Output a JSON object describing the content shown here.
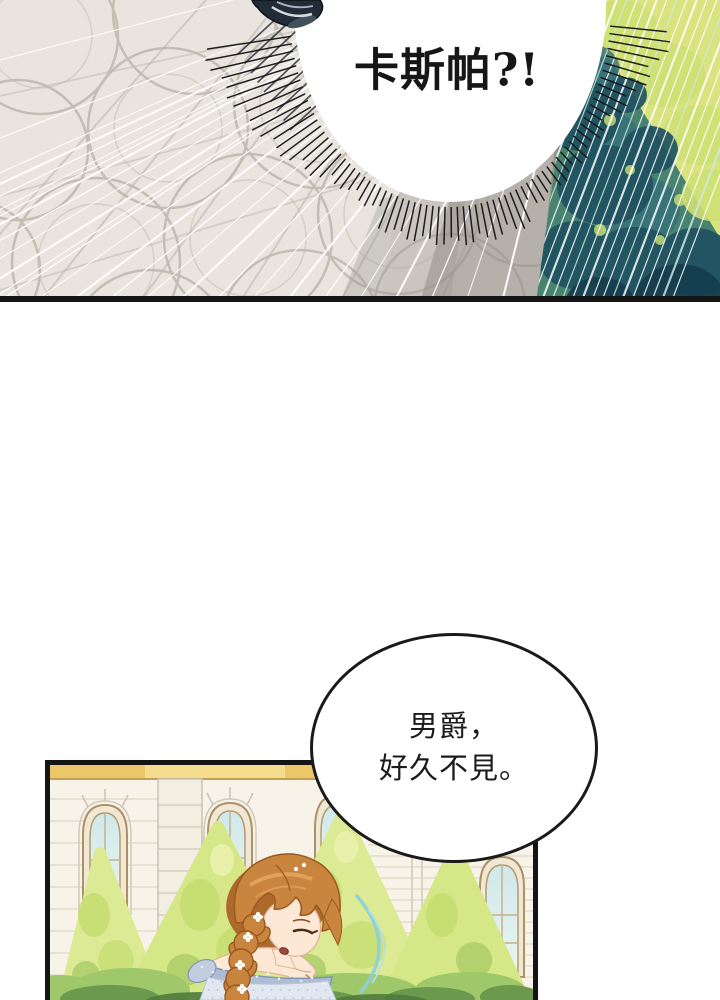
{
  "page": {
    "type": "comic-page",
    "background": "#ffffff"
  },
  "panel1": {
    "label": "courtyard-shout-panel",
    "bubble_text": "卡斯帕?!",
    "colors": {
      "floor": "#e9e5de",
      "floor_pattern": "#b6b1a5",
      "floor_shadow": "#8f8b85",
      "foliage_dark": "#1f5260",
      "foliage_mid": "#47836e",
      "foliage_light": "#d9e37f",
      "ink": "#151515",
      "speedline": "#ffffff"
    }
  },
  "panel2": {
    "label": "garden-greeting-panel",
    "bubble_line1": "男爵，",
    "bubble_line2": "好久不見。",
    "colors": {
      "facade": "#f7f3e9",
      "gold_band": "#ecc768",
      "window_glass": "#cfe9ec",
      "tree_light": "#dcea93",
      "tree_speckle": "#c3dc6e",
      "bush_dark": "#6b9a4f",
      "hair": "#c9843e",
      "hair_shadow": "#ad6a2b",
      "skin": "#fde8d6",
      "dress_band": "#aebdd3",
      "dress_body": "#e2e8f1",
      "motion_arc": "#8fd0d6",
      "ink": "#151515"
    }
  }
}
